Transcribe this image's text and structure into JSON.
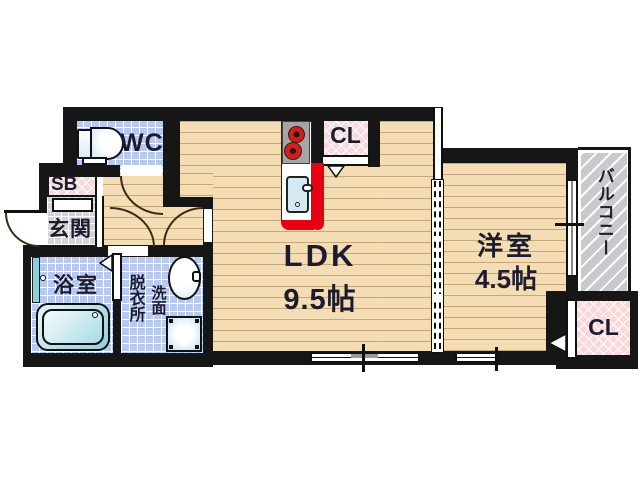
{
  "plan": {
    "type": "apartment floor plan",
    "rooms": {
      "wc": "WC",
      "shoe_box": "SB",
      "entrance": "玄関",
      "bathroom": "浴室",
      "dressing_room": "脱衣所",
      "washstand": "洗面",
      "ldk_name": "LDK",
      "ldk_size": "9.5帖",
      "western_room_name": "洋室",
      "western_room_size": "4.5帖",
      "closet_ldk": "CL",
      "closet_western": "CL",
      "balcony": "バルコニー"
    },
    "colors": {
      "wall": "#161616",
      "wood_floor": "#f4ddb5",
      "tile_blue": "#b9c8ee",
      "closet_pink": "#f8d8da",
      "entrance_gray": "#d6d2d6",
      "balcony_gray": "#c9c9cd",
      "kitchen_red": "#e60012",
      "text": "#1c1c2e"
    }
  }
}
